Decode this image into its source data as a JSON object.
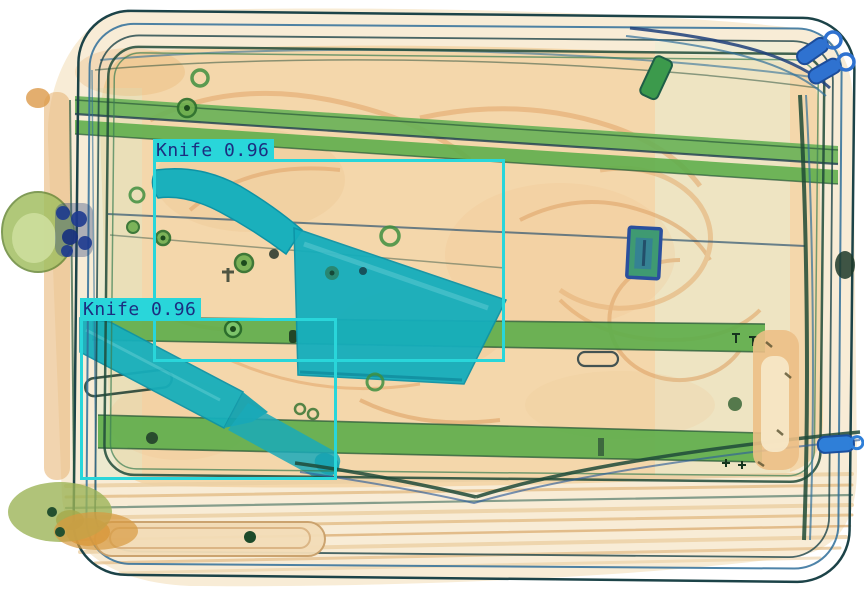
{
  "scene": {
    "type": "xray-baggage-scan",
    "description": "Airport security X-ray scan of a suitcase lying on its side; organic materials appear orange, straps and frame appear green, metal knife blades appear teal, zipper hardware appears blue",
    "background_color": "#ffffff",
    "colors": {
      "organic_orange": "#f4d7ab",
      "strap_green": "#5fae4c",
      "metal_teal": "#18b1bd",
      "hardware_blue": "#2f72d0",
      "outline_dark": "#1c4348"
    }
  },
  "overlay": {
    "box_color": "#29d6da",
    "label_bg": "#29d6da",
    "label_text_color": "#1c2e80",
    "border_px": 3
  },
  "detections": [
    {
      "label": "Knife",
      "score": 0.96,
      "display": "Knife 0.96",
      "bbox": {
        "x": 153,
        "y": 159,
        "w": 352,
        "h": 203
      }
    },
    {
      "label": "Knife",
      "score": 0.96,
      "display": "Knife 0.96",
      "bbox": {
        "x": 80,
        "y": 318,
        "w": 257,
        "h": 162
      }
    }
  ]
}
